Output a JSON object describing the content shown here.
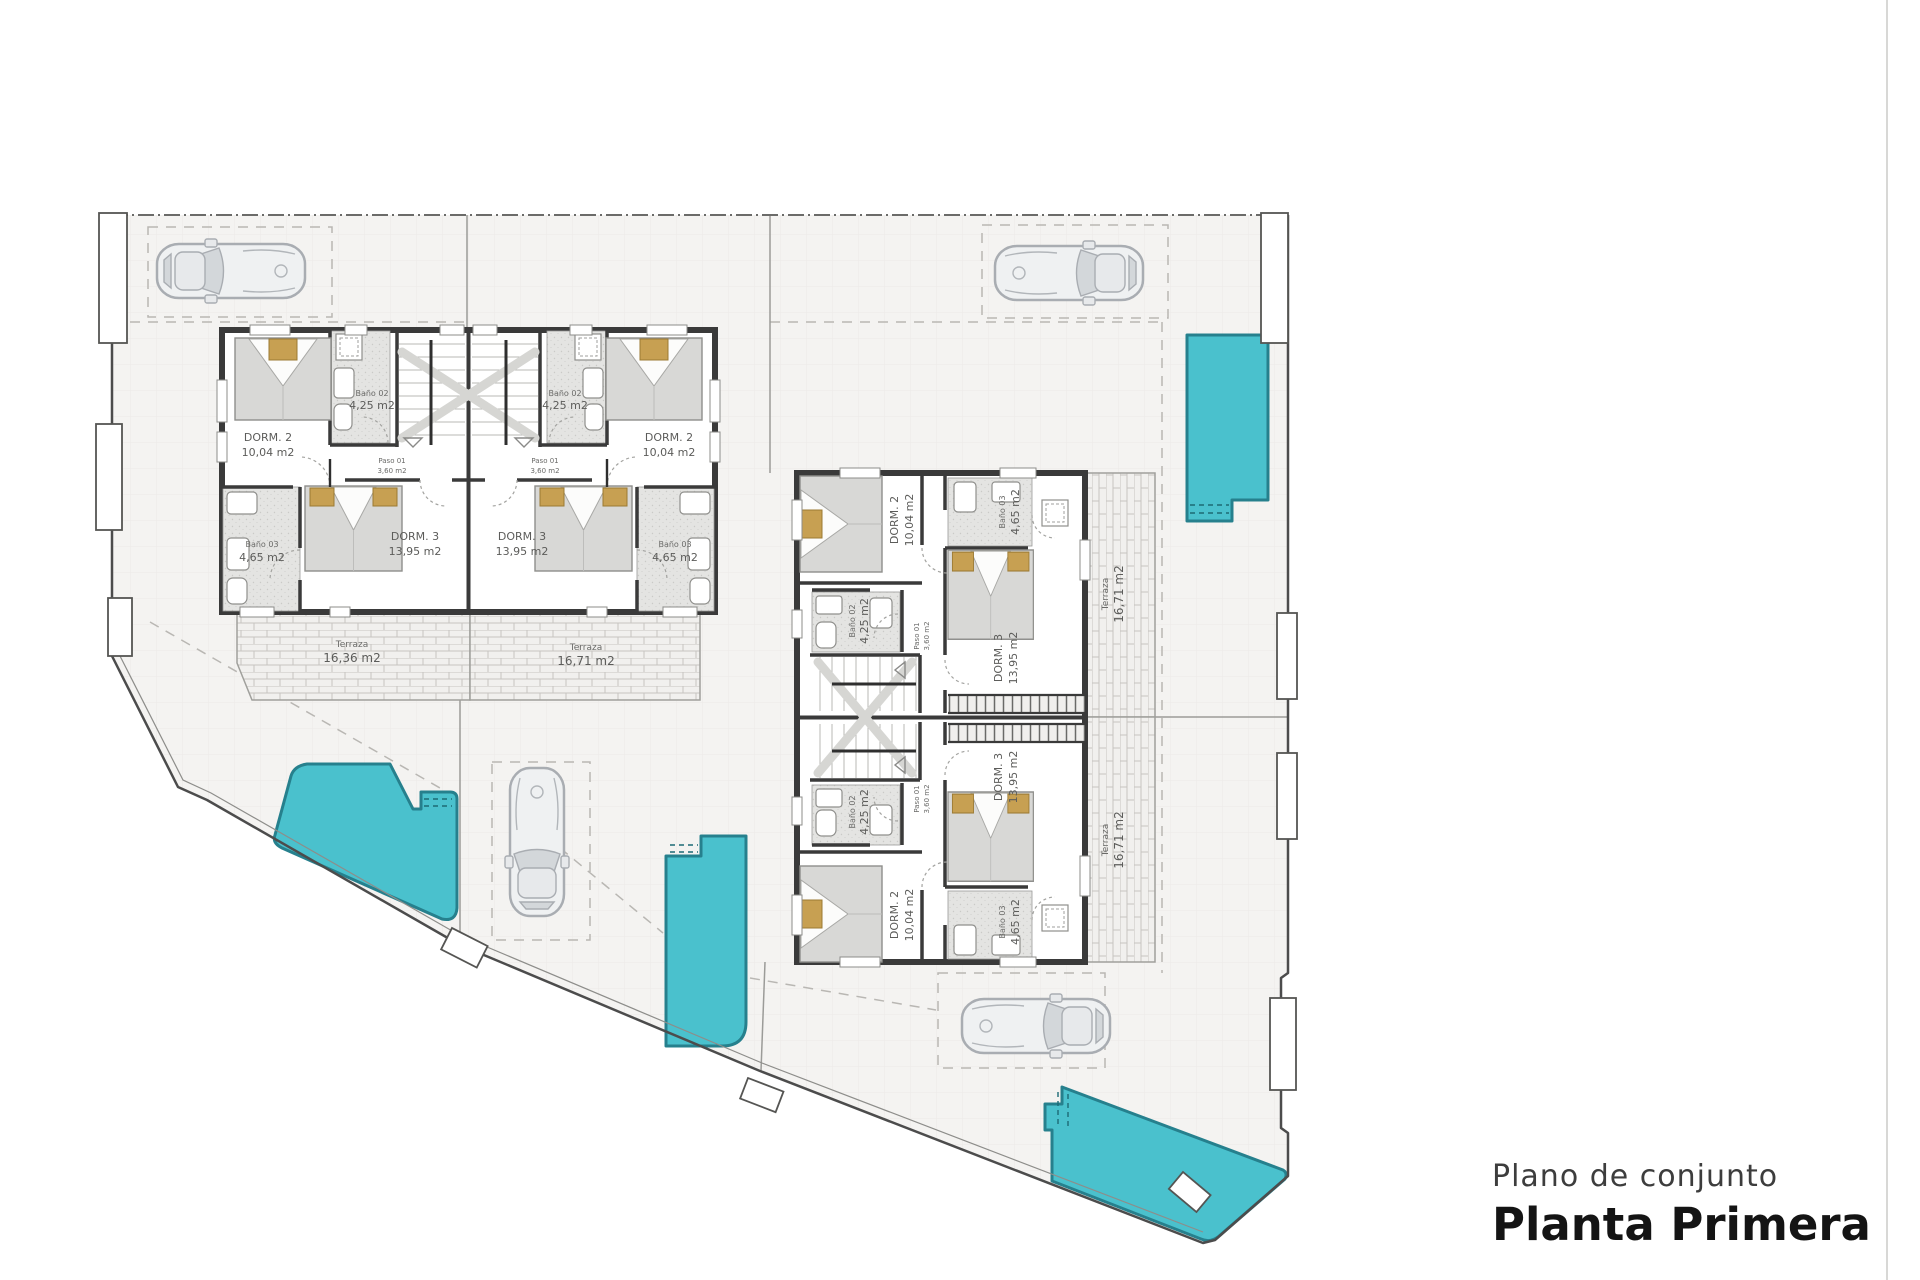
{
  "title": {
    "subtitle": "Plano de conjunto",
    "heading": "Planta Primera"
  },
  "rooms": {
    "dorm2_name": "DORM. 2",
    "dorm2_area": "10,04 m2",
    "dorm3_name": "DORM. 3",
    "dorm3_area": "13,95 m2",
    "bano02_name": "Baño 02",
    "bano02_area": "4,25 m2",
    "bano03_name": "Baño 03",
    "bano03_area": "4,65 m2",
    "paso01_name": "Paso 01",
    "paso01_area": "3,60 m2"
  },
  "terrazas": {
    "name": "Terraza",
    "area_left": "16,36 m2",
    "area_right": "16,71 m2",
    "area_b": "16,71 m2"
  },
  "colors": {
    "pool_fill": "#4ac1cd",
    "pool_stroke": "#26808d",
    "wall": "#3a3a3a",
    "plot_fill": "#f4f3f1",
    "label": "#5c5c5a"
  }
}
